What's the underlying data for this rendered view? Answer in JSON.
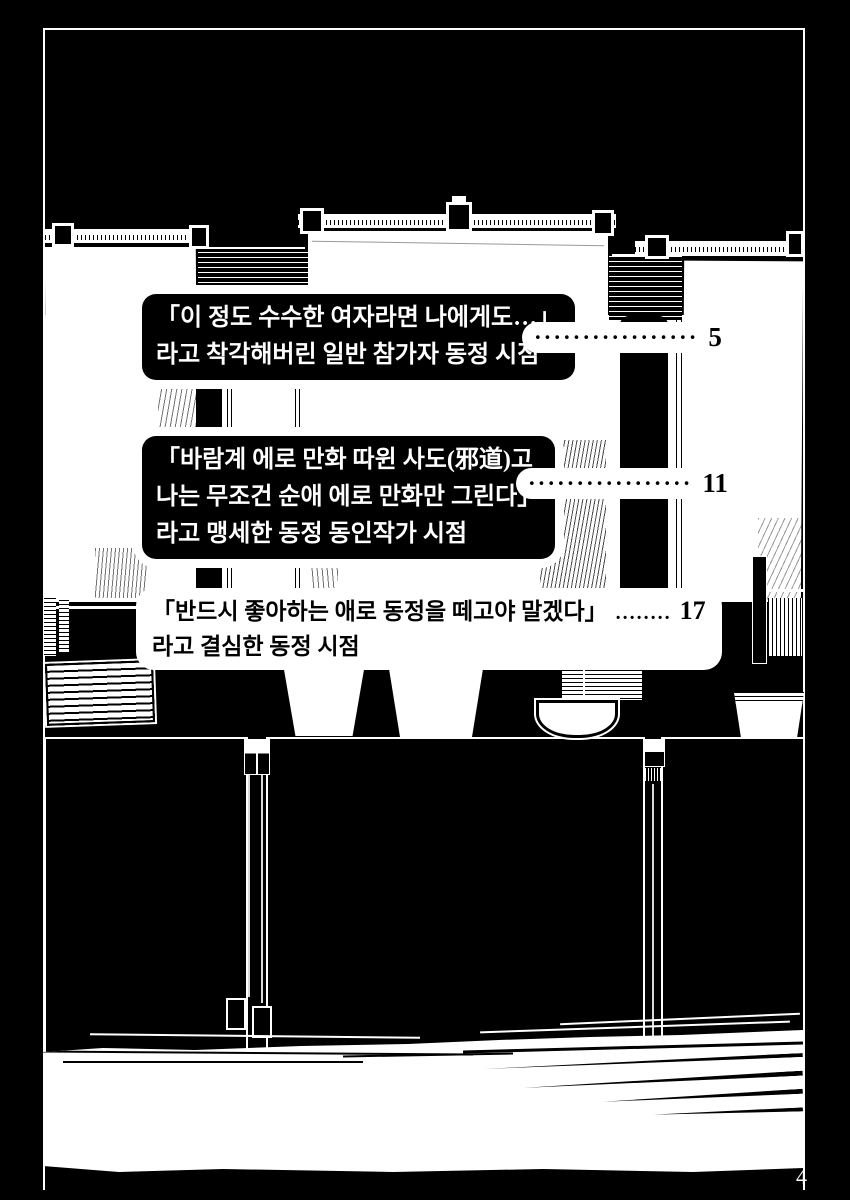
{
  "colors": {
    "ink": "#000000",
    "paper": "#ffffff"
  },
  "folio": {
    "page_number": "4"
  },
  "toc": {
    "entries": [
      {
        "line1": "「이 정도 수수한 여자라면 나에게도…」",
        "line2": "라고 착각해버린 일반 참가자 동정 시점",
        "leader": "·················",
        "page": "5"
      },
      {
        "line1": "「바람계 에로 만화 따윈 사도(邪道)고",
        "line2": "나는 무조건 순애 에로 만화만 그린다」",
        "line3": "라고 맹세한 동정 동인작가 시점",
        "leader": "·················",
        "page": "11"
      },
      {
        "line1": "「반드시 좋아하는 애로 동정을 떼고야 말겠다」",
        "line2": "라고 결심한 동정 시점",
        "leader": "........",
        "page": "17"
      }
    ]
  }
}
